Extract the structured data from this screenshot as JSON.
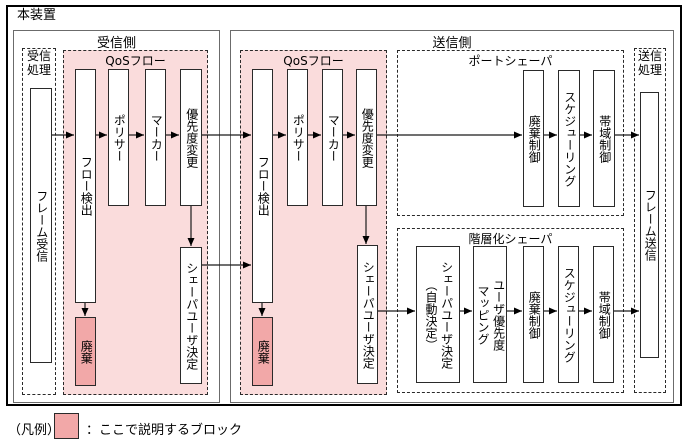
{
  "device_label": "本装置",
  "rx": {
    "section_label": "受信側",
    "proc_label": "受信\n処理",
    "frame_rx": "フレーム受信",
    "qos_label": "QoSフロー",
    "flow_detect": "フロー検出",
    "policer": "ポリサー",
    "marker": "マーカー",
    "priority_change": "優先度変更",
    "discard": "廃棄",
    "shaper_user": "シェーパユーザ決定"
  },
  "tx": {
    "section_label": "送信側",
    "qos_label": "QoSフロー",
    "flow_detect": "フロー検出",
    "policer": "ポリサー",
    "marker": "マーカー",
    "priority_change": "優先度変更",
    "discard": "廃棄",
    "shaper_user": "シェーパユーザ決定",
    "port_shaper": {
      "label": "ポートシェーパ",
      "discard_control": "廃棄制御",
      "scheduling": "スケジューリング",
      "bandwidth_control": "帯域制御"
    },
    "hier_shaper": {
      "label": "階層化シェーパ",
      "shaper_user_auto": "シェーパユーザ決定\n（自動決定）",
      "user_priority_mapping": "ユーザ優先度\nマッピング",
      "discard_control": "廃棄制御",
      "scheduling": "スケジューリング",
      "bandwidth_control": "帯域制御"
    },
    "proc_label": "送信\n処理",
    "frame_tx": "フレーム送信"
  },
  "legend": {
    "prefix": "（凡例）",
    "description": "：ここで説明するブロック"
  },
  "colors": {
    "highlight_bg": "#FADCDC",
    "highlight_block": "#F2A8A8"
  }
}
